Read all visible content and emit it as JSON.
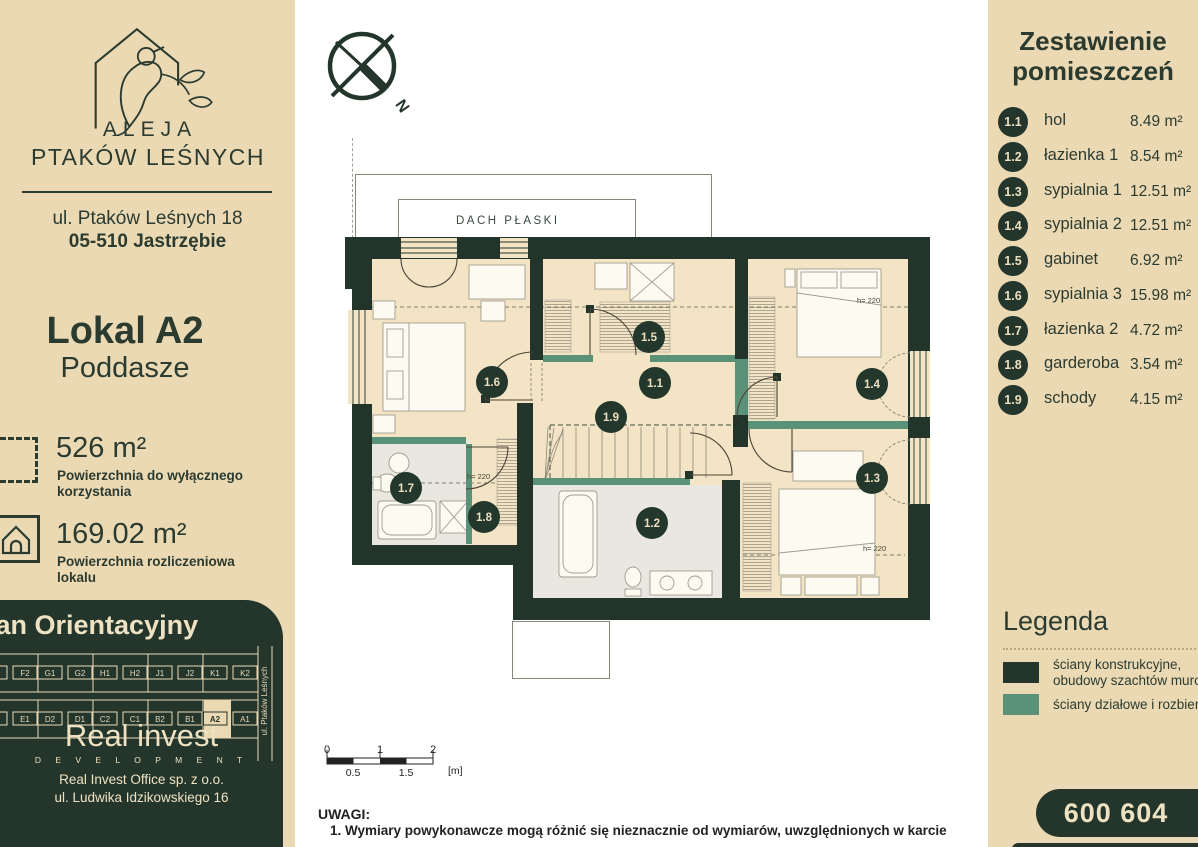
{
  "brand": {
    "line1": "ALEJA",
    "line2": "PTAKÓW LEŚNYCH",
    "address1": "ul. Ptaków Leśnych 18",
    "address2": "05-510 Jastrzębie"
  },
  "unit": {
    "title": "Lokal A2",
    "subtitle": "Poddasze",
    "area_exclusive": "526 m²",
    "area_exclusive_label": "Powierzchnia do wyłącznego korzystania",
    "area_billing": "169.02 m²",
    "area_billing_label": "Powierzchnia rozliczeniowa lokalu"
  },
  "orientation": {
    "title": "Plan Orientacyjny",
    "street": "ul. Ptaków Leśnych",
    "top_row": [
      [
        "F1",
        "F2"
      ],
      [
        "G1",
        "G2"
      ],
      [
        "H1",
        "H2"
      ],
      [
        "J1",
        "J2"
      ],
      [
        "K1",
        "K2"
      ]
    ],
    "bottom_row": [
      [
        "E2",
        "E1"
      ],
      [
        "D2",
        "D1"
      ],
      [
        "C2",
        "C1"
      ],
      [
        "B2",
        "B1"
      ],
      [
        "A2",
        "A1"
      ]
    ],
    "highlight": "A2"
  },
  "developer": {
    "name": "Real invest",
    "tagline": "D E V E L O P M E N T",
    "office1": "Real Invest Office sp. z o.o.",
    "office2": "ul. Ludwika Idzikowskiego 16"
  },
  "plan": {
    "north": "N",
    "roof_label": "DACH PŁASKI",
    "height_label": "h= 220"
  },
  "rooms": {
    "title1": "Zestawienie",
    "title2": "pomieszczeń",
    "rows": [
      {
        "id": "1.1",
        "name": "hol",
        "area": "8.49 m²"
      },
      {
        "id": "1.2",
        "name": "łazienka 1",
        "area": "8.54 m²"
      },
      {
        "id": "1.3",
        "name": "sypialnia 1",
        "area": "12.51 m²"
      },
      {
        "id": "1.4",
        "name": "sypialnia 2",
        "area": "12.51 m²"
      },
      {
        "id": "1.5",
        "name": "gabinet",
        "area": "6.92 m²"
      },
      {
        "id": "1.6",
        "name": "sypialnia 3",
        "area": "15.98 m²"
      },
      {
        "id": "1.7",
        "name": "łazienka 2",
        "area": "4.72 m²"
      },
      {
        "id": "1.8",
        "name": "garderoba",
        "area": "3.54 m²"
      },
      {
        "id": "1.9",
        "name": "schody",
        "area": "4.15 m²"
      }
    ]
  },
  "legend": {
    "title": "Legenda",
    "item1_line1": "ściany konstrukcyjne,",
    "item1_line2": "obudowy szachtów murowanych",
    "item2": "ściany działowe i rozbieralne"
  },
  "contact": {
    "phone": "600 604 604"
  },
  "scale": {
    "t0": "0",
    "t1": "1",
    "t2": "2",
    "b1": "0.5",
    "b2": "1.5",
    "unit": "[m]"
  },
  "notes": {
    "heading": "UWAGI:",
    "line1": "1.  Wymiary powykonawcze mogą różnić się nieznacznie od wymiarów, uwzględnionych w karcie"
  },
  "colors": {
    "dark": "#24362b",
    "teal": "#5a9277",
    "beige": "#ebd9b4",
    "floor": "#f2e4c4"
  }
}
